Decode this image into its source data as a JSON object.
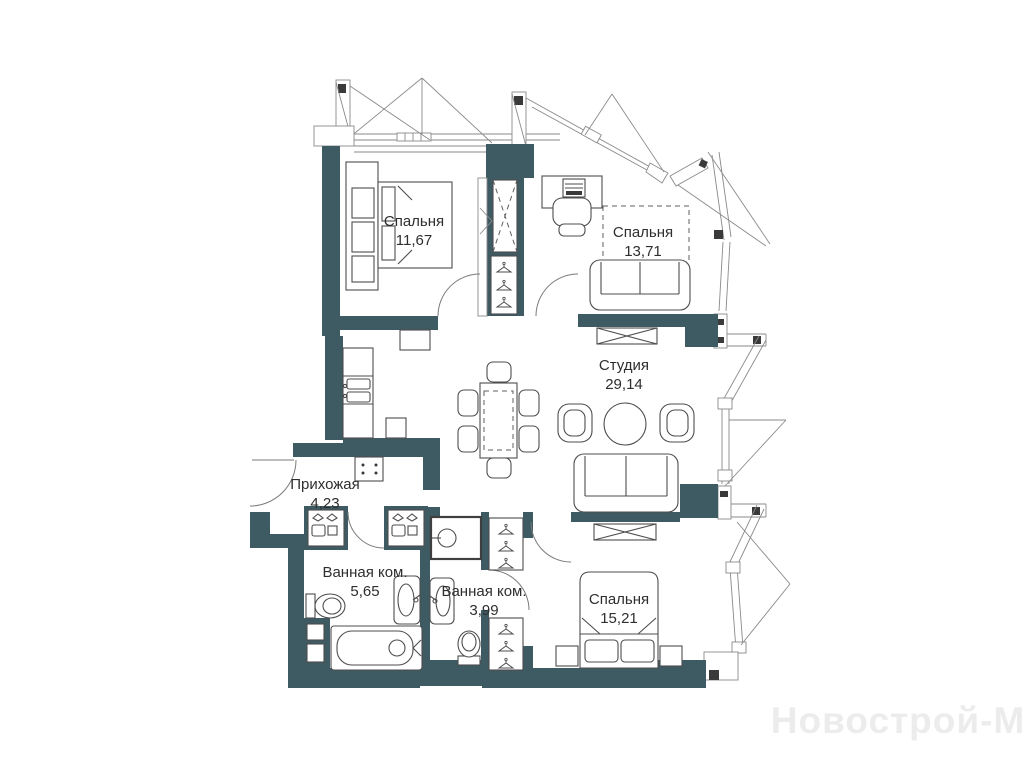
{
  "rooms": [
    {
      "name": "Спальня",
      "area": "11,67"
    },
    {
      "name": "Спальня",
      "area": "13,71"
    },
    {
      "name": "Студия",
      "area": "29,14"
    },
    {
      "name": "Прихожая",
      "area": "4,23"
    },
    {
      "name": "Ванная ком.",
      "area": "5,65"
    },
    {
      "name": "Ванная ком.",
      "area": "3,99"
    },
    {
      "name": "Спальня",
      "area": "15,21"
    }
  ],
  "watermark": "Новострой-М",
  "colors": {
    "wall": "#3e5a63",
    "furniture_line": "#4d4d4d",
    "background": "#ffffff",
    "watermark": "#ececec"
  }
}
